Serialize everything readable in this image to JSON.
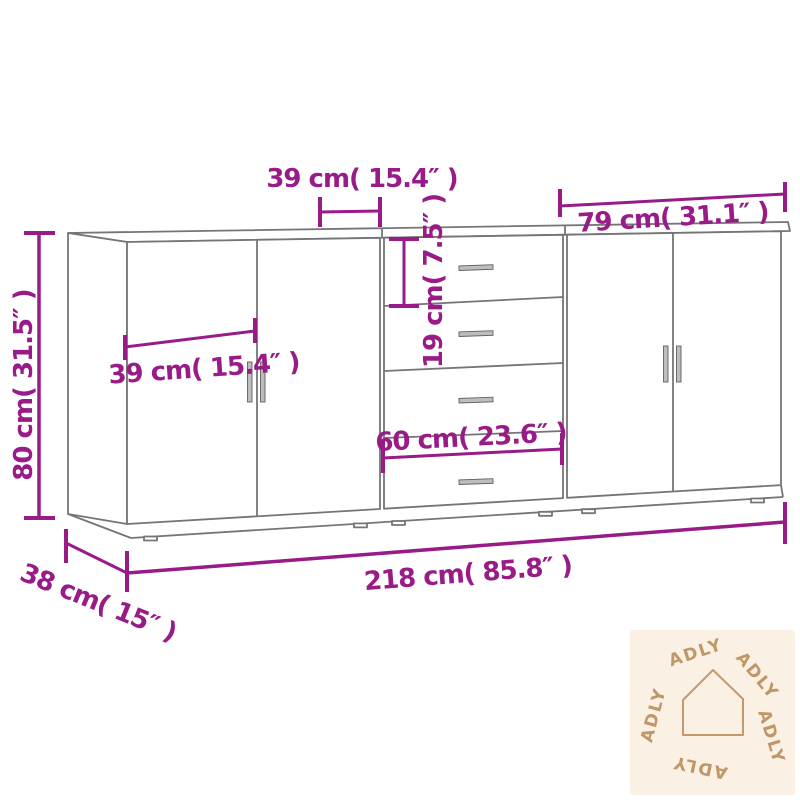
{
  "image_type": "product dimension diagram of a 3-piece sideboard",
  "colors": {
    "dimension_annotation": "#981b87",
    "furniture_outline": "#757575",
    "handle_fill": "#bdbdbd",
    "watermark_background": "#fbf0e4",
    "watermark_foreground": "#bf9768",
    "page_background": "#ffffff"
  },
  "dimensions": {
    "top_door_width": "39 cm( 15.4″ )",
    "right_unit_width": "79  cm( 31.1″ )",
    "drawer_height": "19 cm( 7.5″ )",
    "left_door_width": "39 cm( 15.4″ )",
    "overall_height": "80 cm( 31.5″ )",
    "drawer_unit_width": "60 cm( 23.6″ )",
    "overall_width": "218 cm( 85.8″ )",
    "overall_depth": "38 cm( 15″ )"
  },
  "furniture": {
    "units": [
      "two-door cabinet",
      "four-drawer chest",
      "two-door cabinet"
    ],
    "drawer_count": 4,
    "door_count": 4
  },
  "watermark": {
    "brand": "ADLY",
    "icon": "house-outline-icon",
    "brand_repeat_count": 5
  }
}
